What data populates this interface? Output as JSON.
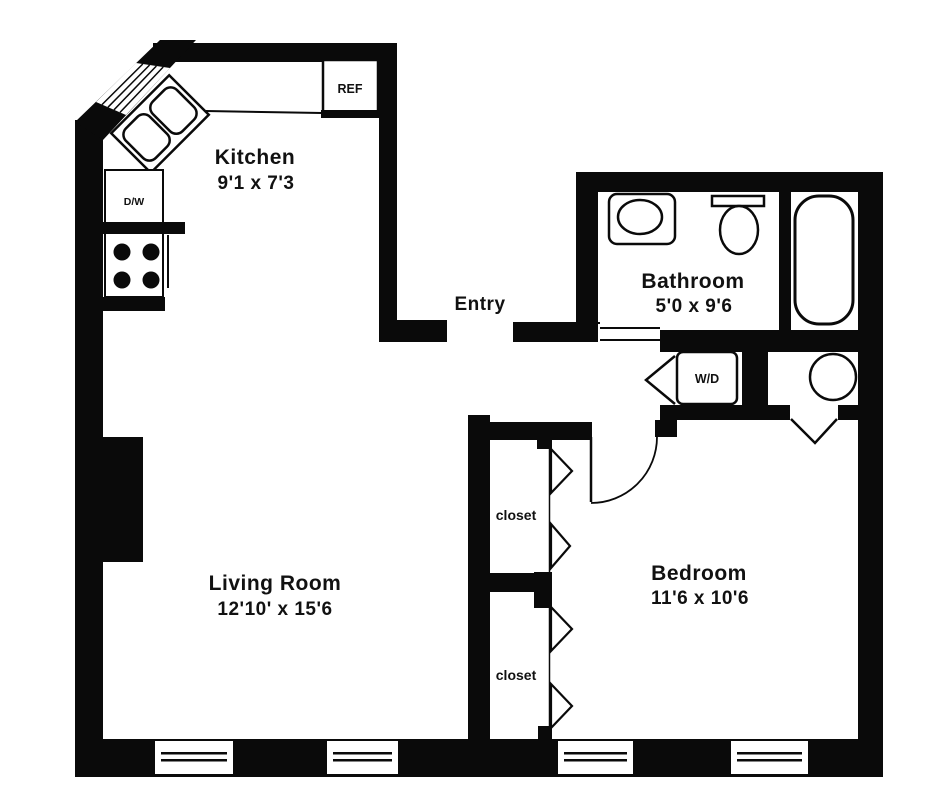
{
  "plan": {
    "type": "apartment-floor-plan",
    "rooms": {
      "kitchen": {
        "label": "Kitchen",
        "dims": "9'1 x 7'3"
      },
      "entry": {
        "label": "Entry"
      },
      "bathroom": {
        "label": "Bathroom",
        "dims": "5'0 x 9'6"
      },
      "living_room": {
        "label": "Living Room",
        "dims": "12'10' x 15'6"
      },
      "bedroom": {
        "label": "Bedroom",
        "dims": "11'6 x 10'6"
      },
      "closet_upper": {
        "label": "closet"
      },
      "closet_lower": {
        "label": "closet"
      }
    },
    "fixtures": {
      "refrigerator": {
        "label": "REF"
      },
      "dishwasher": {
        "label": "D/W"
      },
      "washer_dryer": {
        "label": "W/D"
      }
    },
    "colors": {
      "wall": "#0a0a0a",
      "background": "#ffffff",
      "text": "#111111"
    }
  }
}
